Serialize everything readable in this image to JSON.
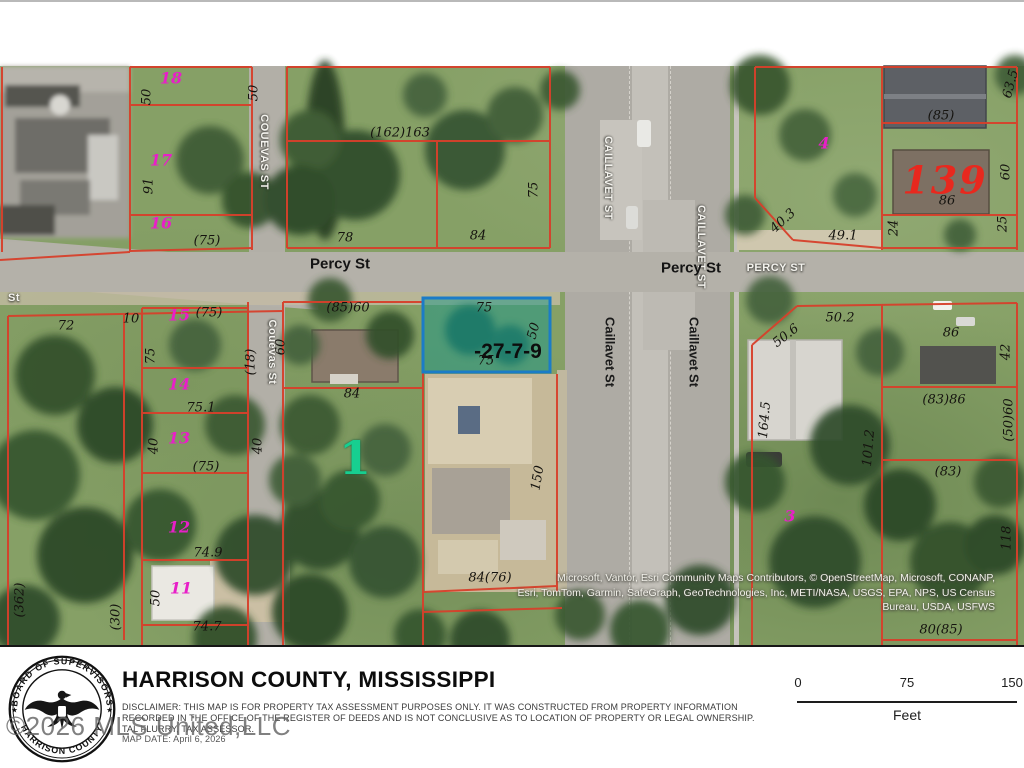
{
  "colors": {
    "parcel_line": "#d7402b",
    "highlight_border": "#1b7cc7",
    "highlight_fill": "rgba(25,150,135,0.5)",
    "parcel_number": "#e81fc8",
    "teal_number": "#17cf90",
    "red_number": "#e8281e"
  },
  "map": {
    "highlighted_parcel_id": "-27-7-9",
    "attribution": [
      "Microsoft, Vantor, Esri Community Maps Contributors, © OpenStreetMap, Microsoft, CONANP,",
      "Esri, TomTom, Garmin, SafeGraph, GeoTechnologies, Inc, METI/NASA, USGS, EPA, NPS, US Census",
      "Bureau, USDA, USFWS"
    ],
    "labels": [
      {
        "t": "18",
        "x": 171,
        "y": 78,
        "c": "pnum"
      },
      {
        "t": "50",
        "x": 147,
        "y": 97,
        "r": -90
      },
      {
        "t": "50",
        "x": 254,
        "y": 93,
        "r": -90
      },
      {
        "t": "17",
        "x": 161,
        "y": 160,
        "c": "pnum"
      },
      {
        "t": "91",
        "x": 149,
        "y": 186,
        "r": -90
      },
      {
        "t": "16",
        "x": 161,
        "y": 223,
        "c": "pnum"
      },
      {
        "t": "(75)",
        "x": 207,
        "y": 241
      },
      {
        "t": "(162)163",
        "x": 400,
        "y": 133
      },
      {
        "t": "78",
        "x": 345,
        "y": 238
      },
      {
        "t": "84",
        "x": 478,
        "y": 236
      },
      {
        "t": "75",
        "x": 534,
        "y": 190,
        "r": -90
      },
      {
        "t": "COUEVAS ST",
        "x": 264,
        "y": 152,
        "r": 90,
        "c": "street-w"
      },
      {
        "t": "CAILLAVET ST",
        "x": 608,
        "y": 178,
        "r": 90,
        "c": "street-w"
      },
      {
        "t": "CAILLAVET ST",
        "x": 701,
        "y": 247,
        "r": 90,
        "c": "street-w"
      },
      {
        "t": "4",
        "x": 824,
        "y": 143,
        "c": "pnum"
      },
      {
        "t": "(85)",
        "x": 941,
        "y": 116
      },
      {
        "t": "139",
        "x": 945,
        "y": 180,
        "c": "big-red"
      },
      {
        "t": "86",
        "x": 947,
        "y": 201
      },
      {
        "t": "60",
        "x": 1006,
        "y": 172,
        "r": -90
      },
      {
        "t": "63.5",
        "x": 1011,
        "y": 84,
        "r": -75
      },
      {
        "t": "24",
        "x": 894,
        "y": 228,
        "r": -90
      },
      {
        "t": "25",
        "x": 1003,
        "y": 224,
        "r": -90
      },
      {
        "t": "40.3",
        "x": 783,
        "y": 221,
        "r": -42
      },
      {
        "t": "49.1",
        "x": 843,
        "y": 236
      },
      {
        "t": "Percy St",
        "x": 340,
        "y": 264,
        "c": "street-b"
      },
      {
        "t": "Percy St",
        "x": 691,
        "y": 268,
        "c": "street-b"
      },
      {
        "t": "PERCY ST",
        "x": 776,
        "y": 268,
        "c": "street-w"
      },
      {
        "t": "St",
        "x": 14,
        "y": 298,
        "c": "street-w"
      },
      {
        "t": "72",
        "x": 66,
        "y": 326
      },
      {
        "t": "10",
        "x": 131,
        "y": 319
      },
      {
        "t": "15",
        "x": 179,
        "y": 315,
        "c": "pnum"
      },
      {
        "t": "(75)",
        "x": 209,
        "y": 313
      },
      {
        "t": "75",
        "x": 151,
        "y": 356,
        "r": -90
      },
      {
        "t": "(18)",
        "x": 251,
        "y": 362,
        "r": -90
      },
      {
        "t": "14",
        "x": 179,
        "y": 384,
        "c": "pnum"
      },
      {
        "t": "75.1",
        "x": 201,
        "y": 408
      },
      {
        "t": "13",
        "x": 179,
        "y": 438,
        "c": "pnum"
      },
      {
        "t": "40",
        "x": 154,
        "y": 446,
        "r": -90
      },
      {
        "t": "40",
        "x": 258,
        "y": 446,
        "r": -90
      },
      {
        "t": "(75)",
        "x": 206,
        "y": 467
      },
      {
        "t": "12",
        "x": 179,
        "y": 527,
        "c": "pnum"
      },
      {
        "t": "74.9",
        "x": 208,
        "y": 553
      },
      {
        "t": "11",
        "x": 181,
        "y": 588,
        "c": "pnum"
      },
      {
        "t": "50",
        "x": 156,
        "y": 598,
        "r": -90
      },
      {
        "t": "74.7",
        "x": 207,
        "y": 627
      },
      {
        "t": "(362)",
        "x": 20,
        "y": 600,
        "r": -90
      },
      {
        "t": "(30)",
        "x": 116,
        "y": 617,
        "r": -90
      },
      {
        "t": "Couevas St",
        "x": 272,
        "y": 352,
        "r": 90,
        "c": "street-w"
      },
      {
        "t": "(85)60",
        "x": 348,
        "y": 308
      },
      {
        "t": "60",
        "x": 281,
        "y": 347,
        "r": -90
      },
      {
        "t": "84",
        "x": 352,
        "y": 394
      },
      {
        "t": "1",
        "x": 355,
        "y": 458,
        "c": "big-teal"
      },
      {
        "t": "75",
        "x": 484,
        "y": 308
      },
      {
        "t": "50",
        "x": 534,
        "y": 331,
        "r": -75
      },
      {
        "t": "-27-7-9",
        "x": 508,
        "y": 352,
        "c": "hl"
      },
      {
        "t": "75",
        "x": 486,
        "y": 361
      },
      {
        "t": "150",
        "x": 538,
        "y": 478,
        "r": -80
      },
      {
        "t": "84(76)",
        "x": 490,
        "y": 578
      },
      {
        "t": "Caillavet St",
        "x": 610,
        "y": 352,
        "r": 90,
        "c": "street-b2"
      },
      {
        "t": "Caillavet St",
        "x": 694,
        "y": 352,
        "r": 90,
        "c": "street-b2"
      },
      {
        "t": "50.2",
        "x": 840,
        "y": 318
      },
      {
        "t": "50.6",
        "x": 786,
        "y": 336,
        "r": -38
      },
      {
        "t": "164.5",
        "x": 765,
        "y": 420,
        "r": -85
      },
      {
        "t": "101.2",
        "x": 869,
        "y": 448,
        "r": -85
      },
      {
        "t": "3",
        "x": 790,
        "y": 516,
        "c": "pnum"
      },
      {
        "t": "86",
        "x": 951,
        "y": 333
      },
      {
        "t": "42",
        "x": 1006,
        "y": 352,
        "r": -90
      },
      {
        "t": "(83)86",
        "x": 944,
        "y": 400
      },
      {
        "t": "(50)60",
        "x": 1009,
        "y": 420,
        "r": -90
      },
      {
        "t": "(83)",
        "x": 948,
        "y": 472
      },
      {
        "t": "118",
        "x": 1007,
        "y": 538,
        "r": -90
      },
      {
        "t": "80(85)",
        "x": 941,
        "y": 630
      }
    ],
    "geometry": {
      "red_lines": [
        [
          130,
          67,
          130,
          252
        ],
        [
          252,
          67,
          252,
          250
        ],
        [
          130,
          67,
          252,
          67
        ],
        [
          130,
          105,
          252,
          105
        ],
        [
          130,
          215,
          252,
          215
        ],
        [
          130,
          251,
          252,
          248
        ],
        [
          0,
          260,
          130,
          252
        ],
        [
          2,
          67,
          2,
          252
        ],
        [
          287,
          67,
          287,
          248
        ],
        [
          550,
          67,
          550,
          248
        ],
        [
          287,
          67,
          550,
          67
        ],
        [
          287,
          141,
          550,
          141
        ],
        [
          437,
          141,
          437,
          248
        ],
        [
          287,
          248,
          550,
          248
        ],
        [
          755,
          67,
          755,
          198
        ],
        [
          755,
          198,
          793,
          240
        ],
        [
          793,
          240,
          882,
          248
        ],
        [
          882,
          67,
          882,
          250
        ],
        [
          1017,
          67,
          1017,
          250
        ],
        [
          882,
          67,
          1017,
          67
        ],
        [
          882,
          123,
          1017,
          123
        ],
        [
          882,
          215,
          1017,
          215
        ],
        [
          882,
          248,
          1017,
          248
        ],
        [
          755,
          67,
          882,
          67
        ],
        [
          8,
          316,
          283,
          311
        ],
        [
          8,
          316,
          8,
          645
        ],
        [
          124,
          313,
          124,
          640
        ],
        [
          142,
          308,
          142,
          645
        ],
        [
          248,
          302,
          248,
          645
        ],
        [
          283,
          302,
          283,
          645
        ],
        [
          142,
          308,
          248,
          308
        ],
        [
          142,
          368,
          248,
          368
        ],
        [
          142,
          413,
          248,
          413
        ],
        [
          142,
          473,
          248,
          473
        ],
        [
          142,
          560,
          248,
          560
        ],
        [
          142,
          625,
          248,
          625
        ],
        [
          283,
          302,
          423,
          302
        ],
        [
          283,
          388,
          423,
          388
        ],
        [
          423,
          298,
          423,
          645
        ],
        [
          557,
          374,
          557,
          592
        ],
        [
          423,
          592,
          557,
          586
        ],
        [
          423,
          612,
          562,
          608
        ],
        [
          797,
          306,
          1017,
          303
        ],
        [
          752,
          345,
          797,
          306
        ],
        [
          752,
          345,
          752,
          645
        ],
        [
          882,
          305,
          882,
          645
        ],
        [
          882,
          387,
          1017,
          387
        ],
        [
          882,
          460,
          1017,
          460
        ],
        [
          1017,
          303,
          1017,
          645
        ],
        [
          882,
          640,
          1017,
          640
        ]
      ],
      "highlight_parcel": {
        "x": 423,
        "y": 298,
        "w": 127,
        "h": 74
      }
    }
  },
  "footer": {
    "title": "HARRISON COUNTY, MISSISSIPPI",
    "disclaimer1": "DISCLAIMER: THIS MAP IS FOR PROPERTY TAX ASSESSMENT PURPOSES ONLY. IT WAS CONSTRUCTED FROM PROPERTY INFORMATION",
    "disclaimer2": "RECORDED IN THE OFFICE OF THE REGISTER OF DEEDS AND IS NOT CONCLUSIVE AS TO LOCATION OF PROPERTY OR LEGAL OWNERSHIP.",
    "assessor": "TAL FLURRY, TAX ASSESSOR.",
    "map_date": "MAP DATE: April 6, 2026",
    "watermark": "©2026 MLS United,LLC",
    "seal": {
      "top": "BOARD OF SUPERVISORS",
      "bottom": "HARRISON COUNTY",
      "star": "★"
    },
    "scale": {
      "start": "0",
      "mid": "75",
      "end": "150",
      "unit": "Feet"
    }
  }
}
